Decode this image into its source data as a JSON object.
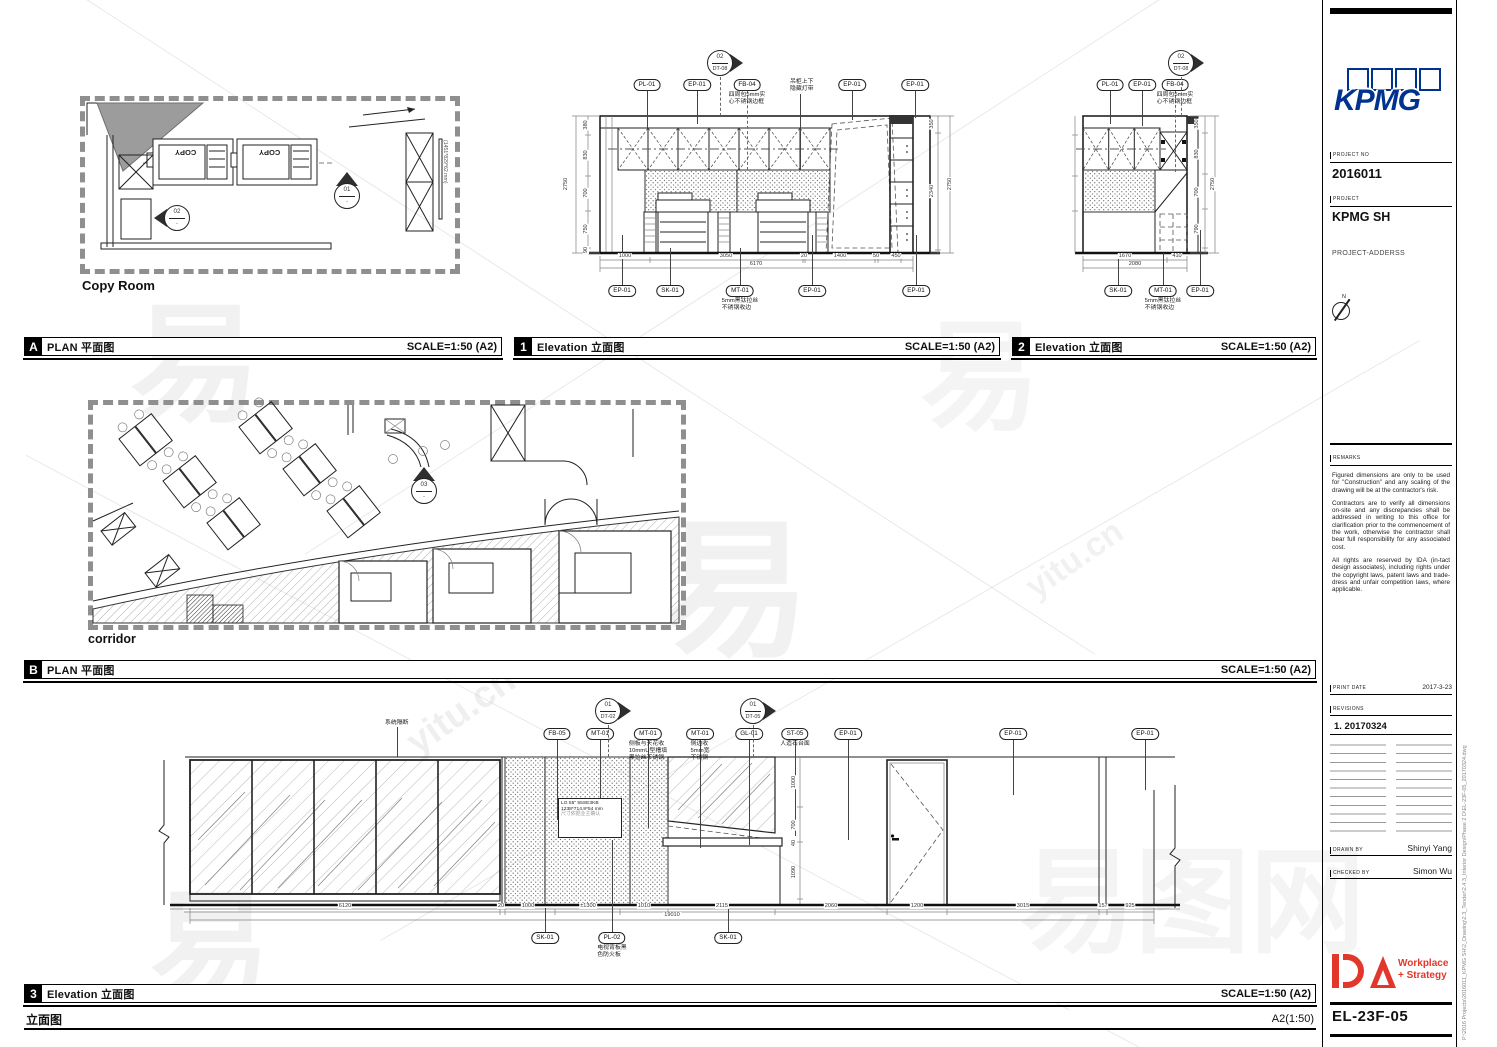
{
  "watermarks": {
    "big": "易图网",
    "char": "易",
    "site": "yitu.cn"
  },
  "panel_a": {
    "letter": "A",
    "title": "PLAN 平面图",
    "scale": "SCALE=1:50 (A2)",
    "caption": "Copy Room",
    "copy_text": "COPY",
    "tv_label": "(1451*829*62 mm)"
  },
  "panel_1": {
    "number": "1",
    "title": "Elevation 立面图",
    "scale": "SCALE=1:50 (A2)"
  },
  "panel_2": {
    "number": "2",
    "title": "Elevation 立面图",
    "scale": "SCALE=1:50 (A2)"
  },
  "panel_b": {
    "letter": "B",
    "title": "PLAN 平面图",
    "scale": "SCALE=1:50 (A2)",
    "caption": "corridor"
  },
  "panel_3": {
    "number": "3",
    "title": "Elevation 立面图",
    "scale": "SCALE=1:50 (A2)"
  },
  "footer": {
    "label": "立面图",
    "size": "A2(1:50)"
  },
  "tv_box": {
    "line1": "LG 55\" 55SE3KB",
    "line2": "1238*714.9*54 mm",
    "line3": "尺寸依据业主确认"
  },
  "titleblock": {
    "logo": "KPMG",
    "project_no_label": "PROJECT NO",
    "project_no": "2016011",
    "project_label": "PROJECT",
    "project_name": "KPMG SH",
    "address": "PROJECT-ADDERSS",
    "north_label": "N",
    "remarks_label": "REMARKS",
    "remarks_1": "Figured dimensions are only to be used for \"Construction\" and any scaling of the drawing will be at the contractor's risk.",
    "remarks_2": "Contractors are to verify all dimensions on-site and any discrepancies shall be addressed in writing to this office for clarification prior to the commencement of the work, otherwise the contractor shall bear full responsibility for any associated cost.",
    "remarks_3": "All rights are reserved by IDA (in-tact design associates), including rights under the copyright laws, patent laws and trade-dress and unfair competition laws, where applicable.",
    "print_date_label": "PRINT DATE",
    "print_date": "2017-3-23",
    "revisions_label": "REVISIONS",
    "revision_1": "1. 20170324",
    "drawn_by_label": "DRAWN BY",
    "drawn_by": "Shinyi Yang",
    "checked_by_label": "CHECKED BY",
    "checked_by": "Simon Wu",
    "ida_word_1": "Workplace",
    "ida_word_2": "+ Strategy",
    "sheet_no": "EL-23F-05",
    "file_path": "P:\\2016 Projects\\2016011_KPMG SH\\2_Drawing\\2.3_Tender\\2.4.3_Interior Design\\Phase 2 D\\EL-23F-05_20170324.dwg"
  },
  "overlays": {
    "callouts": [
      {
        "label": "PL-01",
        "x": 647,
        "y": 79,
        "l": [
          90,
          128
        ]
      },
      {
        "label": "EP-01",
        "x": 697,
        "y": 79,
        "l": [
          90,
          124
        ]
      },
      {
        "label": "FB-04",
        "x": 747,
        "y": 79,
        "l": [
          90,
          170
        ],
        "dash": true,
        "note": [
          "四周包5mm实",
          "心不锈钢边框"
        ]
      },
      {
        "label": "EP-01",
        "x": 852,
        "y": 79,
        "l": [
          90,
          120
        ]
      },
      {
        "label": "EP-01",
        "x": 915,
        "y": 79,
        "l": [
          90,
          118
        ]
      },
      {
        "label": "EP-01",
        "x": 622,
        "y": 285,
        "l": [
          235,
          285
        ]
      },
      {
        "label": "SK-01",
        "x": 670,
        "y": 285,
        "l": [
          248,
          285
        ]
      },
      {
        "label": "MT-01",
        "x": 740,
        "y": 285,
        "l": [
          248,
          285
        ],
        "note": [
          "5mm黑钛拉丝",
          "不锈钢收边"
        ]
      },
      {
        "label": "EP-01",
        "x": 812,
        "y": 285,
        "l": [
          235,
          285
        ]
      },
      {
        "label": "EP-01",
        "x": 916,
        "y": 285,
        "l": [
          235,
          285
        ]
      },
      {
        "label": "PL-01",
        "x": 1110,
        "y": 79,
        "l": [
          90,
          124
        ]
      },
      {
        "label": "EP-01",
        "x": 1142,
        "y": 79,
        "l": [
          90,
          126
        ]
      },
      {
        "label": "FB-04",
        "x": 1175,
        "y": 79,
        "l": [
          90,
          172
        ],
        "dash": true,
        "note": [
          "四周包5mm实",
          "心不锈钢边框"
        ]
      },
      {
        "label": "SK-01",
        "x": 1118,
        "y": 285,
        "l": [
          253,
          285
        ]
      },
      {
        "label": "MT-01",
        "x": 1163,
        "y": 285,
        "l": [
          253,
          285
        ],
        "note": [
          "5mm黑钛拉丝",
          "不锈钢收边"
        ]
      },
      {
        "label": "EP-01",
        "x": 1200,
        "y": 285,
        "l": [
          230,
          285
        ]
      },
      {
        "label": "FB-05",
        "x": 557,
        "y": 728,
        "l": [
          739,
          820
        ]
      },
      {
        "label": "MT-01",
        "x": 600,
        "y": 728,
        "l": [
          739,
          798
        ]
      },
      {
        "label": "MT-01",
        "x": 648,
        "y": 728,
        "l": [
          739,
          828
        ],
        "note": [
          "侧板与天花收",
          "10mmU型槽填",
          "黑拉丝不锈钢"
        ]
      },
      {
        "label": "MT-01",
        "x": 700,
        "y": 728,
        "l": [
          739,
          848
        ],
        "note": [
          "侧边收",
          "5mm宽",
          "不锈钢"
        ]
      },
      {
        "label": "GL-01",
        "x": 749,
        "y": 728,
        "l": [
          739,
          845
        ]
      },
      {
        "label": "ST-05",
        "x": 795,
        "y": 728,
        "l": [
          739,
          836
        ],
        "note": [
          "人造石台面"
        ]
      },
      {
        "label": "EP-01",
        "x": 848,
        "y": 728,
        "l": [
          739,
          840
        ]
      },
      {
        "label": "EP-01",
        "x": 1013,
        "y": 728,
        "l": [
          739,
          795
        ]
      },
      {
        "label": "EP-01",
        "x": 1145,
        "y": 728,
        "l": [
          739,
          790
        ]
      },
      {
        "label": "SK-01",
        "x": 545,
        "y": 932,
        "l": [
          908,
          932
        ]
      },
      {
        "label": "PL-02",
        "x": 612,
        "y": 932,
        "l": [
          840,
          932
        ],
        "note": [
          "电视背板黑",
          "色防火板"
        ]
      },
      {
        "label": "SK-01",
        "x": 728,
        "y": 932,
        "l": [
          908,
          932
        ]
      }
    ],
    "notes": [
      {
        "lines": [
          "吊柜上下",
          "隐藏灯带"
        ],
        "x": 790,
        "y": 79,
        "lx": 800,
        "l": [
          94,
          170
        ]
      },
      {
        "lines": [
          "系统隔断"
        ],
        "x": 385,
        "y": 720,
        "lx": 397,
        "l": [
          727,
          757
        ]
      }
    ],
    "dims": [
      {
        "t": "2750",
        "x": 566,
        "y": 184,
        "r": 1
      },
      {
        "t": "380",
        "x": 586,
        "y": 125,
        "r": 1
      },
      {
        "t": "830",
        "x": 586,
        "y": 155,
        "r": 1
      },
      {
        "t": "700",
        "x": 586,
        "y": 193,
        "r": 1
      },
      {
        "t": "750",
        "x": 586,
        "y": 229,
        "r": 1
      },
      {
        "t": "90",
        "x": 586,
        "y": 250,
        "r": 1
      },
      {
        "t": "350",
        "x": 932,
        "y": 124,
        "r": 1
      },
      {
        "t": "2340",
        "x": 932,
        "y": 191,
        "r": 1
      },
      {
        "t": "2750",
        "x": 950,
        "y": 184,
        "r": 1
      },
      {
        "t": "1000",
        "x": 625,
        "y": 256
      },
      {
        "t": "3050",
        "x": 726,
        "y": 256
      },
      {
        "t": "20",
        "x": 804,
        "y": 256
      },
      {
        "t": "1400",
        "x": 840,
        "y": 256
      },
      {
        "t": "50",
        "x": 876,
        "y": 256
      },
      {
        "t": "450",
        "x": 896,
        "y": 256
      },
      {
        "t": "6170",
        "x": 756,
        "y": 264
      },
      {
        "t": "350",
        "x": 1197,
        "y": 124,
        "r": 1
      },
      {
        "t": "830",
        "x": 1197,
        "y": 154,
        "r": 1
      },
      {
        "t": "700",
        "x": 1197,
        "y": 192,
        "r": 1
      },
      {
        "t": "790",
        "x": 1197,
        "y": 229,
        "r": 1
      },
      {
        "t": "2750",
        "x": 1213,
        "y": 184,
        "r": 1
      },
      {
        "t": "1670",
        "x": 1125,
        "y": 256
      },
      {
        "t": "410",
        "x": 1177,
        "y": 256
      },
      {
        "t": "2080",
        "x": 1135,
        "y": 264
      },
      {
        "t": "1000",
        "x": 794,
        "y": 782,
        "r": 1
      },
      {
        "t": "700",
        "x": 794,
        "y": 825,
        "r": 1
      },
      {
        "t": "40",
        "x": 794,
        "y": 843,
        "r": 1
      },
      {
        "t": "1090",
        "x": 794,
        "y": 872,
        "r": 1
      },
      {
        "t": "6120",
        "x": 345,
        "y": 906
      },
      {
        "t": "20",
        "x": 501,
        "y": 906
      },
      {
        "t": "1000",
        "x": 528,
        "y": 906
      },
      {
        "t": "±1300",
        "x": 588,
        "y": 906
      },
      {
        "t": "1010",
        "x": 644,
        "y": 906
      },
      {
        "t": "2115",
        "x": 722,
        "y": 906
      },
      {
        "t": "2060",
        "x": 831,
        "y": 906
      },
      {
        "t": "1200",
        "x": 917,
        "y": 906
      },
      {
        "t": "3015",
        "x": 1023,
        "y": 906
      },
      {
        "t": "157",
        "x": 1103,
        "y": 906
      },
      {
        "t": "925",
        "x": 1130,
        "y": 906
      },
      {
        "t": "19010",
        "x": 672,
        "y": 915
      }
    ],
    "markers": [
      {
        "num": "02",
        "ref": "DT-08",
        "x": 720,
        "y": 63,
        "dir": "right",
        "stem": [
          77,
          116
        ]
      },
      {
        "num": "02",
        "ref": "DT-08",
        "x": 1181,
        "y": 63,
        "dir": "right",
        "stem": [
          77,
          116
        ]
      },
      {
        "num": "01",
        "ref": "DT-02",
        "x": 608,
        "y": 711,
        "dir": "right",
        "stem": [
          725,
          757
        ]
      },
      {
        "num": "01",
        "ref": "DT-05",
        "x": 753,
        "y": 711,
        "dir": "right",
        "stem": [
          725,
          757
        ]
      },
      {
        "num": "01",
        "ref": "-",
        "x": 347,
        "y": 196,
        "dir": "up"
      },
      {
        "num": "02",
        "ref": "-",
        "x": 177,
        "y": 218,
        "dir": "left"
      },
      {
        "num": "03",
        "ref": "-",
        "x": 424,
        "y": 491,
        "dir": "up"
      }
    ]
  }
}
